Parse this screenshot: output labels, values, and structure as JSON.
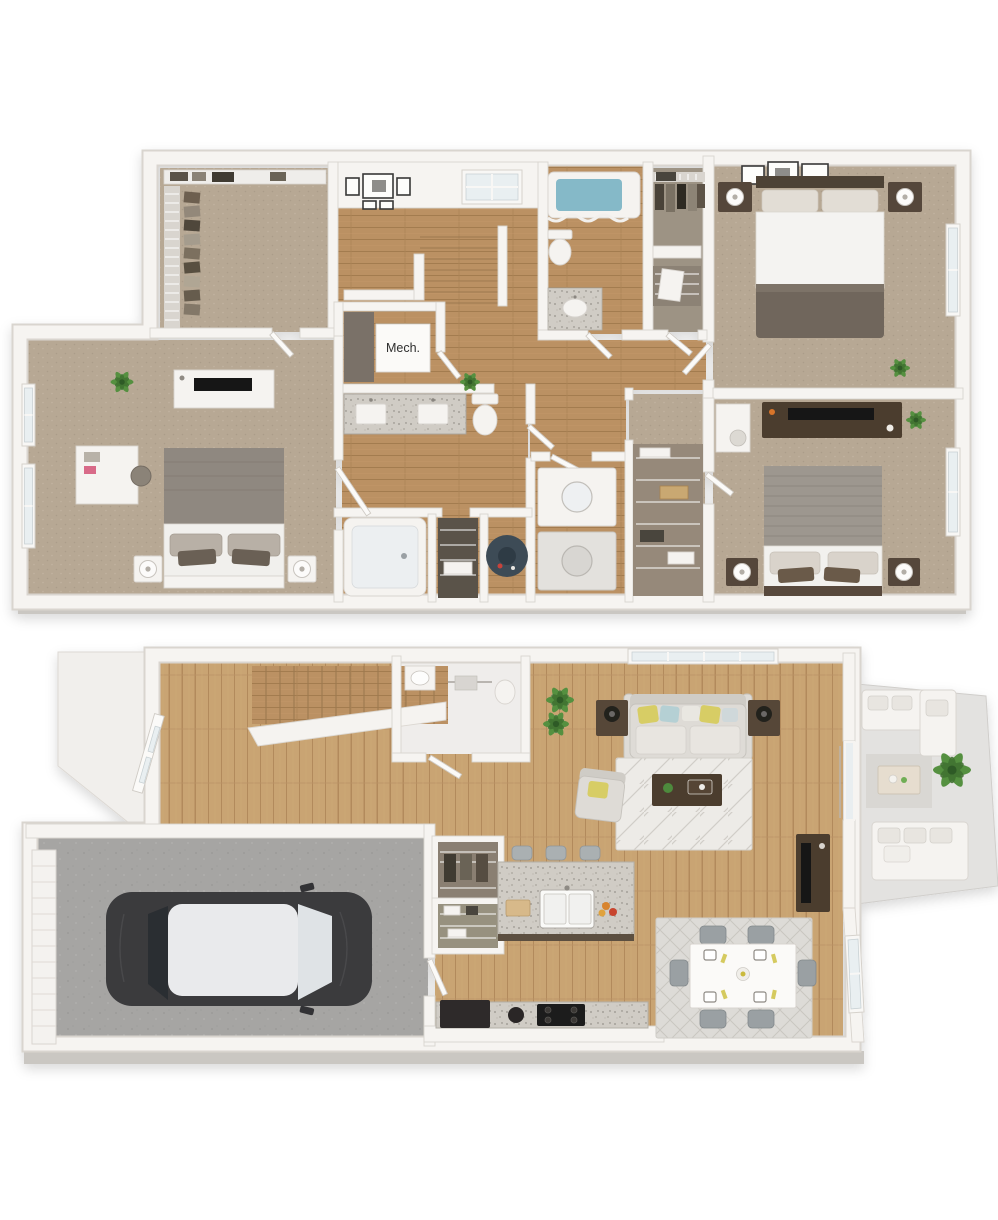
{
  "scene": {
    "type": "3d-floor-plan-rendering",
    "floors_visible": 2
  },
  "labels": {
    "mech_room": "Mech."
  },
  "palette": {
    "background": "#ffffff",
    "wall": "#f6f4f1",
    "wall_edge": "#d9d5cf",
    "slab_shadow": "#cac7c2",
    "carpet": "#b7a894",
    "wood_upper": "#bb9163",
    "wood_lower": "#c9a473",
    "concrete": "#a6a5a3",
    "granite": "#d0ccc5",
    "car_body": "#3a3a3d",
    "car_glass": "#2c2e30",
    "water_heater_tank": "#3e4b57",
    "tub_water": "#85b9c8",
    "pillow_yellow": "#d7cd65",
    "pillow_blue": "#b5d0d4",
    "plant_green": "#559040",
    "dark_wood_furniture": "#4c3c2d"
  }
}
